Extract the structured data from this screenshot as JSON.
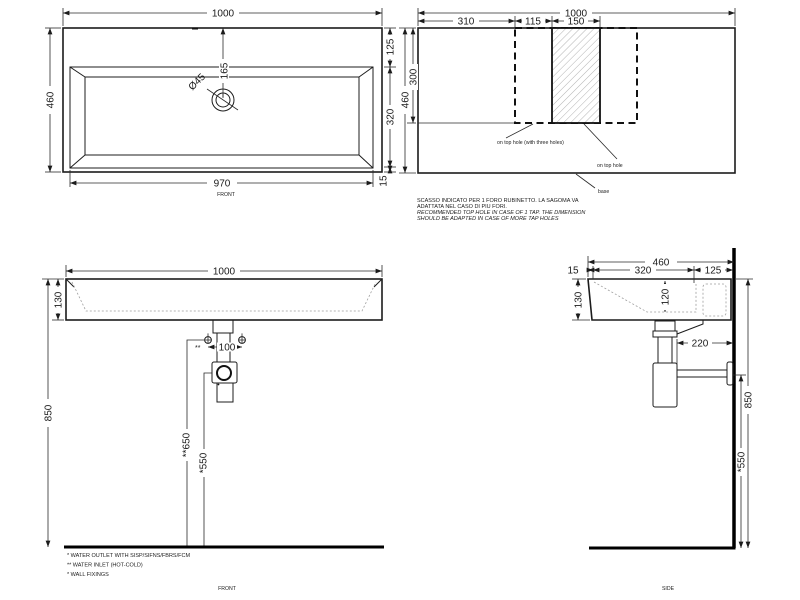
{
  "plan": {
    "view_label": "FRONT",
    "dims": {
      "width": "1000",
      "depth": "460",
      "back": "125",
      "basin_depth": "320",
      "front_lip": "15",
      "inner_width": "970",
      "hole_offset": "165",
      "hole_diameter": "Ø45"
    }
  },
  "tap_plan": {
    "dims": {
      "width": "1000",
      "offset_left": "310",
      "gap": "115",
      "hole_zone_width": "150",
      "depth": "460",
      "hole_zone_depth": "300"
    },
    "labels": {
      "three_holes": "on top hole (with three holes)",
      "top_hole": "on top hole",
      "base": "base"
    },
    "notes": {
      "it1": "SCASSO INDICATO PER 1 FORO RUBINETTO. LA SAGOMA VA",
      "it2": "ADATTATA NEL CASO DI PIU FORI.",
      "en1": "RECOMMENDED TOP HOLE IN CASE OF 1 TAP. THE DIMENSION",
      "en2": "SHOULD BE ADAPTED IN CASE OF MORE TAP HOLES"
    }
  },
  "front": {
    "view_label": "FRONT",
    "dims": {
      "width": "1000",
      "body_height": "130",
      "height": "850",
      "inlet_spacing": "100",
      "inlet_marker": "**",
      "inlet_height": "**650",
      "outlet_height": "*550"
    },
    "notes": {
      "outlet": "* WATER OUTLET WITH SISP/SIFNS/FBRS/FCM",
      "inlet": "** WATER INLET  (HOT-COLD)",
      "fixings": "* WALL FIXINGS"
    }
  },
  "side": {
    "view_label": "SIDE",
    "dims": {
      "depth": "460",
      "front_lip": "15",
      "mid": "320",
      "back": "125",
      "body_height": "130",
      "bowl_depth": "120",
      "trap_to_wall": "220",
      "height": "850",
      "outlet_height": "*550"
    }
  }
}
